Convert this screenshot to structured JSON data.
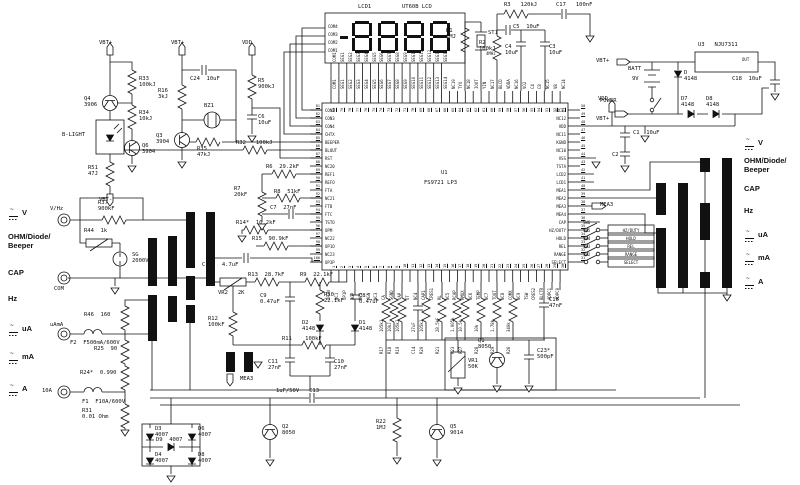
{
  "ic": {
    "ref": "U1",
    "part": "FS9721 LP3",
    "pins_left": [
      "CON2",
      "CON3",
      "CON4",
      "CHTX",
      "BEEPER",
      "BLOUT",
      "RST",
      "NC20",
      "REF1",
      "REFO",
      "FTA",
      "NC21",
      "FTB",
      "FTC",
      "TSTO",
      "OPM",
      "NC22",
      "OP1O",
      "NC23",
      "OP3P"
    ],
    "pins_right": [
      "NC13",
      "NC12",
      "VDD",
      "NC11",
      "KGND",
      "NC10",
      "VSS",
      "TSTA",
      "LCD2",
      "LCD1",
      "MEA1",
      "MEA2",
      "MEA3",
      "MEA4",
      "CAP",
      "HZ/DUTY",
      "HOLD",
      "REL",
      "RANGE",
      "SELECT"
    ],
    "pins_top": [
      "COM1",
      "SEG1",
      "SEG2",
      "SEG3",
      "SEG4",
      "SEG5",
      "SEG6",
      "SEG7",
      "SEG8",
      "SEG9",
      "SEG10",
      "SEG11",
      "SEG12",
      "SEG13",
      "SEG14",
      "NC19",
      "TYO",
      "NC18",
      "IOUT",
      "YIN",
      "NC17",
      "BLCD",
      "VDDA",
      "NC16",
      "VO2",
      "C4",
      "C8",
      "NC15",
      "VB",
      "NC14"
    ],
    "pins_bottom": [
      "OP3N",
      "NC1",
      "OP1P",
      "AGP",
      "NC2",
      "AGN",
      "NC3",
      "CA",
      "SGND",
      "VAP",
      "OT",
      "NC4",
      "CAP1",
      "CRES1",
      "RL",
      "NC5",
      "RCAP",
      "RMUX",
      "NC6",
      "TEMP",
      "NC7",
      "TOUT",
      "NC8",
      "COMX",
      "NC9",
      "TSW",
      "CRES2",
      "BLCTR",
      "ADPC1",
      "ADPC0"
    ],
    "num_left_start": 81,
    "num_top_start": 80,
    "num_right_start": 50,
    "num_bottom_start": 1
  },
  "lcd": {
    "ref": "LCD1",
    "part": "UT60B LCD",
    "value": "8888",
    "minus_sign": true,
    "com_labels": [
      "COM4",
      "COM3",
      "COM2",
      "COM1"
    ],
    "pin_labels": [
      "COM1",
      "SEG1",
      "SEG2",
      "SEG3",
      "SEG4",
      "SEG5",
      "SEG6",
      "SEG7",
      "SEG8",
      "SEG9",
      "SEG10",
      "SEG11",
      "SEG12",
      "SEG13",
      "SEG14"
    ]
  },
  "buttons": [
    {
      "ref": "SW6",
      "label": "HZ/DUTY"
    },
    {
      "ref": "SW5",
      "label": "HOLD"
    },
    {
      "ref": "SW4",
      "label": "REL"
    },
    {
      "ref": "SW3",
      "label": "RANGE"
    },
    {
      "ref": "SW2",
      "label": "SELECT"
    }
  ],
  "selector": {
    "items": [
      "V",
      "OHM/Diode/\nBeeper",
      "CAP",
      "Hz",
      "uA",
      "mA",
      "A"
    ],
    "acdc": [
      true,
      false,
      false,
      false,
      true,
      true,
      true
    ]
  },
  "analog_row": [
    {
      "ref": "R17",
      "val": "105kJ",
      "type": "r"
    },
    {
      "ref": "R18",
      "val": "10kJ",
      "type": "r"
    },
    {
      "ref": "R19",
      "val": "105kJ",
      "type": "r"
    },
    {
      "ref": "C14",
      "val": "27uF",
      "type": "c"
    },
    {
      "ref": "R20",
      "val": "105kJ",
      "type": "r"
    },
    {
      "ref": "R21",
      "val": "28.5kF",
      "type": "r"
    },
    {
      "ref": "R23",
      "val": "1.005k",
      "type": "r"
    },
    {
      "ref": "R27",
      "val": "10.5k",
      "type": "r"
    },
    {
      "ref": "R28",
      "val": "10k",
      "type": "r"
    },
    {
      "ref": "R29",
      "val": "1.78k",
      "type": "r"
    },
    {
      "ref": "R26",
      "val": "340k",
      "type": "r"
    }
  ],
  "labels": {
    "vbtp1": "VBT+",
    "vbtp2": "VBT+",
    "vbtp3": "VBT+",
    "vbtp4": "VBT+",
    "vbtm1": "VBT-",
    "vdd1": "VDD",
    "vdd2": "VDD",
    "q4": "Q4\n3906",
    "q6": "Q6\n3904",
    "q3": "Q3\n3904",
    "q2": "Q2\n8050",
    "q5": "Q5\n9014",
    "q1": "Q1\n8050",
    "r33": "R33\n100kJ",
    "r34": "R34\n10kJ",
    "r51": "R51\n47J",
    "blight": "B-LIGHT",
    "r16": "R16\n3kJ",
    "c24": "C24  10uF",
    "bz1": "BZ1",
    "r35": "R35\n47kJ",
    "r32": "R32   100kJ",
    "r5": "R5\n900kJ",
    "c6": "C6\n10uF",
    "r1": "R1\n1MJ",
    "st1": "ST1",
    "st1v": "4MHz",
    "r3": "R3   120kJ",
    "c5": "C5  10uF",
    "r2": "R2\n100kJ",
    "c4": "C4\n10uF",
    "c3": "C3\n10uF",
    "c17": "C17   100nF",
    "u3": "U3   NJU7311",
    "u3out": "OUT",
    "batt": "BATT",
    "battv": "9V",
    "dprot": "D\n4148",
    "power": "POWER",
    "d7": "D7\n4148",
    "d8": "D8\n4148",
    "c18": "C18  10uF",
    "c1": "C1  10uF",
    "c2": "C2",
    "mea3a": "MEA3",
    "mea3b": "MEA3",
    "vhz": "V/Hz",
    "com": "COM",
    "uama": "uAmA",
    "tena": "10A",
    "r37": "R37\n900kF",
    "r44": "R44  1k",
    "sg": "SG\n2000V",
    "r46": "R46  160",
    "f2": "F2  F500mA/600V",
    "r25": "R25  90",
    "r24": "R24*  0.990",
    "f1": "F1  F10A/600V",
    "r31": "R31\n0.01 Ohm",
    "d3": "D3\n4007",
    "d6": "D6\n4007",
    "d9": "D9  4007",
    "d4": "D4\n4007",
    "d8b": "D8\n4007",
    "c13": "1uF/50V   C13",
    "r22": "R22\n1MJ",
    "c12": "C12   4.7uF",
    "vr2": "VR2   2K",
    "r13": "R13  28.7kF",
    "r9": "R9  22.1kF",
    "r6": "R6  29.2kF",
    "r7": "R7\n20kF",
    "r8": "R8  51kF",
    "c7": "C7  27nF",
    "r14": "R14*  10.2kF",
    "r15": "R15  90.9kF",
    "c9": "C9\n0.47uF",
    "r10": "R10\n22.1kF",
    "c8": "C8\n0.47uF",
    "d2": "D2\n4148",
    "d1": "D1\n4148",
    "r12": "R12\n100kF",
    "r11": "R11    100kF",
    "c11": "C11\n27nF",
    "c10": "C10\n27nF",
    "vr1": "VR1\n50K",
    "c23": "C23*\n500pF",
    "c16": "C16\n47nF"
  }
}
